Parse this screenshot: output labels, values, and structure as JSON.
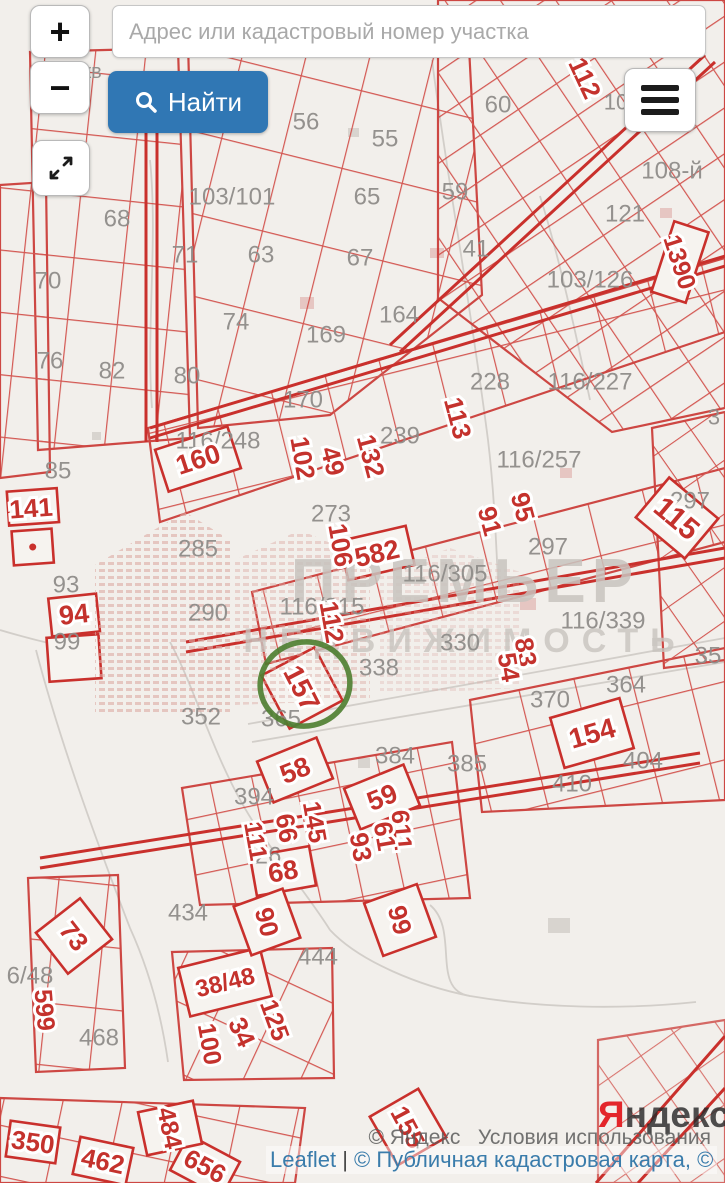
{
  "search": {
    "placeholder": "Адрес или кадастровый номер участка",
    "find_label": "Найти"
  },
  "controls": {
    "zoom_in": "+",
    "zoom_out": "−"
  },
  "watermark": {
    "line1": "ПРЕМЬЕР",
    "line2": "НЕДВИЖИМОСТЬ"
  },
  "logo": {
    "first_letter": "Я",
    "rest": "ндекс"
  },
  "attribution": {
    "copyright_yandex": "© Яндекс",
    "terms": "Условия использования",
    "leaflet": "Leaflet",
    "separator": "|",
    "cadastre": "© Публичная кадастровая карта",
    "trailing": ", ©"
  },
  "map": {
    "colors": {
      "parcel_red": "#cf433d",
      "label_red": "#c4322d",
      "label_gray": "#8f8d8a",
      "highlight_green": "#4c7d2f",
      "road_gray": "#d2cec9"
    },
    "highlight": {
      "label": "157",
      "cx": 305,
      "cy": 684
    },
    "red_labels": [
      {
        "t": "141",
        "x": 31,
        "y": 508,
        "r": -4,
        "s": 26
      },
      {
        "t": "160",
        "x": 198,
        "y": 459,
        "r": -18,
        "s": 27
      },
      {
        "t": "94",
        "x": 74,
        "y": 614,
        "r": -6,
        "s": 27
      },
      {
        "t": "112",
        "x": 585,
        "y": 78,
        "r": 65,
        "s": 26
      },
      {
        "t": "1390",
        "x": 680,
        "y": 262,
        "r": 72,
        "s": 25
      },
      {
        "t": "102",
        "x": 303,
        "y": 458,
        "r": 80,
        "s": 26
      },
      {
        "t": "49",
        "x": 333,
        "y": 461,
        "r": 75,
        "s": 26
      },
      {
        "t": "132",
        "x": 371,
        "y": 456,
        "r": 75,
        "s": 26
      },
      {
        "t": "113",
        "x": 458,
        "y": 418,
        "r": 75,
        "s": 26
      },
      {
        "t": "106",
        "x": 341,
        "y": 545,
        "r": 80,
        "s": 26
      },
      {
        "t": "582",
        "x": 377,
        "y": 553,
        "r": -13,
        "s": 27
      },
      {
        "t": "91",
        "x": 490,
        "y": 521,
        "r": 75,
        "s": 26
      },
      {
        "t": "95",
        "x": 523,
        "y": 507,
        "r": 75,
        "s": 26
      },
      {
        "t": "115",
        "x": 677,
        "y": 518,
        "r": 40,
        "s": 30
      },
      {
        "t": "112",
        "x": 332,
        "y": 622,
        "r": 80,
        "s": 26
      },
      {
        "t": "157",
        "x": 302,
        "y": 688,
        "r": 63,
        "s": 28
      },
      {
        "t": "83",
        "x": 526,
        "y": 652,
        "r": 80,
        "s": 26
      },
      {
        "t": "54",
        "x": 509,
        "y": 667,
        "r": 80,
        "s": 26
      },
      {
        "t": "154",
        "x": 592,
        "y": 733,
        "r": -16,
        "s": 28
      },
      {
        "t": "58",
        "x": 295,
        "y": 770,
        "r": -22,
        "s": 27
      },
      {
        "t": "59",
        "x": 382,
        "y": 797,
        "r": -22,
        "s": 27
      },
      {
        "t": "145",
        "x": 315,
        "y": 822,
        "r": 80,
        "s": 25
      },
      {
        "t": "66",
        "x": 287,
        "y": 828,
        "r": 80,
        "s": 26
      },
      {
        "t": "111",
        "x": 256,
        "y": 841,
        "r": 80,
        "s": 25
      },
      {
        "t": "611",
        "x": 402,
        "y": 830,
        "r": 85,
        "s": 25
      },
      {
        "t": "61",
        "x": 385,
        "y": 836,
        "r": 80,
        "s": 26
      },
      {
        "t": "93",
        "x": 361,
        "y": 847,
        "r": 80,
        "s": 26
      },
      {
        "t": "68",
        "x": 283,
        "y": 871,
        "r": -10,
        "s": 27
      },
      {
        "t": "90",
        "x": 267,
        "y": 922,
        "r": 75,
        "s": 26
      },
      {
        "t": "99",
        "x": 400,
        "y": 920,
        "r": 75,
        "s": 26
      },
      {
        "t": "73",
        "x": 74,
        "y": 936,
        "r": 52,
        "s": 26
      },
      {
        "t": "599",
        "x": 45,
        "y": 1010,
        "r": 85,
        "s": 25
      },
      {
        "t": "38/48",
        "x": 225,
        "y": 982,
        "r": -14,
        "s": 24
      },
      {
        "t": "100",
        "x": 210,
        "y": 1044,
        "r": 80,
        "s": 25
      },
      {
        "t": "34",
        "x": 242,
        "y": 1032,
        "r": 65,
        "s": 26
      },
      {
        "t": "125",
        "x": 275,
        "y": 1020,
        "r": 70,
        "s": 25
      },
      {
        "t": "155",
        "x": 408,
        "y": 1127,
        "r": 62,
        "s": 26
      },
      {
        "t": "350",
        "x": 33,
        "y": 1142,
        "r": 8,
        "s": 26
      },
      {
        "t": "462",
        "x": 103,
        "y": 1161,
        "r": 12,
        "s": 26
      },
      {
        "t": "484",
        "x": 170,
        "y": 1128,
        "r": 78,
        "s": 25
      },
      {
        "t": "656",
        "x": 205,
        "y": 1166,
        "r": 28,
        "s": 26
      }
    ],
    "gray_labels": [
      {
        "t": "кв",
        "x": 92,
        "y": 71,
        "s": 20
      },
      {
        "t": "56",
        "x": 306,
        "y": 121
      },
      {
        "t": "55",
        "x": 385,
        "y": 138
      },
      {
        "t": "60",
        "x": 498,
        "y": 104
      },
      {
        "t": "10",
        "x": 616,
        "y": 102,
        "s": 22
      },
      {
        "t": "108-й",
        "x": 672,
        "y": 170
      },
      {
        "t": "121",
        "x": 625,
        "y": 213
      },
      {
        "t": "68",
        "x": 117,
        "y": 218
      },
      {
        "t": "71",
        "x": 185,
        "y": 254
      },
      {
        "t": "63",
        "x": 261,
        "y": 254
      },
      {
        "t": "65",
        "x": 367,
        "y": 196
      },
      {
        "t": "67",
        "x": 360,
        "y": 257
      },
      {
        "t": "59",
        "x": 455,
        "y": 191
      },
      {
        "t": "41",
        "x": 476,
        "y": 248
      },
      {
        "t": "74",
        "x": 236,
        "y": 321
      },
      {
        "t": "103/101",
        "x": 232,
        "y": 196
      },
      {
        "t": "164",
        "x": 399,
        "y": 314
      },
      {
        "t": "169",
        "x": 326,
        "y": 334
      },
      {
        "t": "170",
        "x": 303,
        "y": 399
      },
      {
        "t": "228",
        "x": 490,
        "y": 381
      },
      {
        "t": "116/227",
        "x": 590,
        "y": 381
      },
      {
        "t": "103/126",
        "x": 590,
        "y": 279
      },
      {
        "t": "239",
        "x": 400,
        "y": 435
      },
      {
        "t": "116/248",
        "x": 218,
        "y": 440
      },
      {
        "t": "116/257",
        "x": 539,
        "y": 459
      },
      {
        "t": "76",
        "x": 50,
        "y": 360
      },
      {
        "t": "82",
        "x": 112,
        "y": 370
      },
      {
        "t": "80",
        "x": 187,
        "y": 375
      },
      {
        "t": "70",
        "x": 48,
        "y": 280
      },
      {
        "t": "85",
        "x": 58,
        "y": 470
      },
      {
        "t": "273",
        "x": 331,
        "y": 513
      },
      {
        "t": "297",
        "x": 548,
        "y": 546
      },
      {
        "t": "297",
        "x": 690,
        "y": 500
      },
      {
        "t": "3",
        "x": 714,
        "y": 417,
        "s": 22
      },
      {
        "t": "285",
        "x": 198,
        "y": 548
      },
      {
        "t": "290",
        "x": 208,
        "y": 612
      },
      {
        "t": "93",
        "x": 66,
        "y": 584
      },
      {
        "t": "99",
        "x": 67,
        "y": 641
      },
      {
        "t": "116/315",
        "x": 322,
        "y": 606
      },
      {
        "t": "116/305",
        "x": 445,
        "y": 573
      },
      {
        "t": "116/339",
        "x": 603,
        "y": 620
      },
      {
        "t": "330",
        "x": 460,
        "y": 642
      },
      {
        "t": "338",
        "x": 379,
        "y": 667
      },
      {
        "t": "352",
        "x": 201,
        "y": 716
      },
      {
        "t": "365",
        "x": 281,
        "y": 718
      },
      {
        "t": "364",
        "x": 626,
        "y": 684
      },
      {
        "t": "370",
        "x": 550,
        "y": 699
      },
      {
        "t": "35",
        "x": 708,
        "y": 655
      },
      {
        "t": "384",
        "x": 395,
        "y": 755
      },
      {
        "t": "385",
        "x": 467,
        "y": 763
      },
      {
        "t": "394",
        "x": 254,
        "y": 796
      },
      {
        "t": "404",
        "x": 643,
        "y": 760
      },
      {
        "t": "410",
        "x": 572,
        "y": 783
      },
      {
        "t": "26",
        "x": 268,
        "y": 855
      },
      {
        "t": "434",
        "x": 188,
        "y": 912
      },
      {
        "t": "444",
        "x": 318,
        "y": 956
      },
      {
        "t": "468",
        "x": 99,
        "y": 1037
      },
      {
        "t": "6/48",
        "x": 30,
        "y": 975
      }
    ]
  }
}
